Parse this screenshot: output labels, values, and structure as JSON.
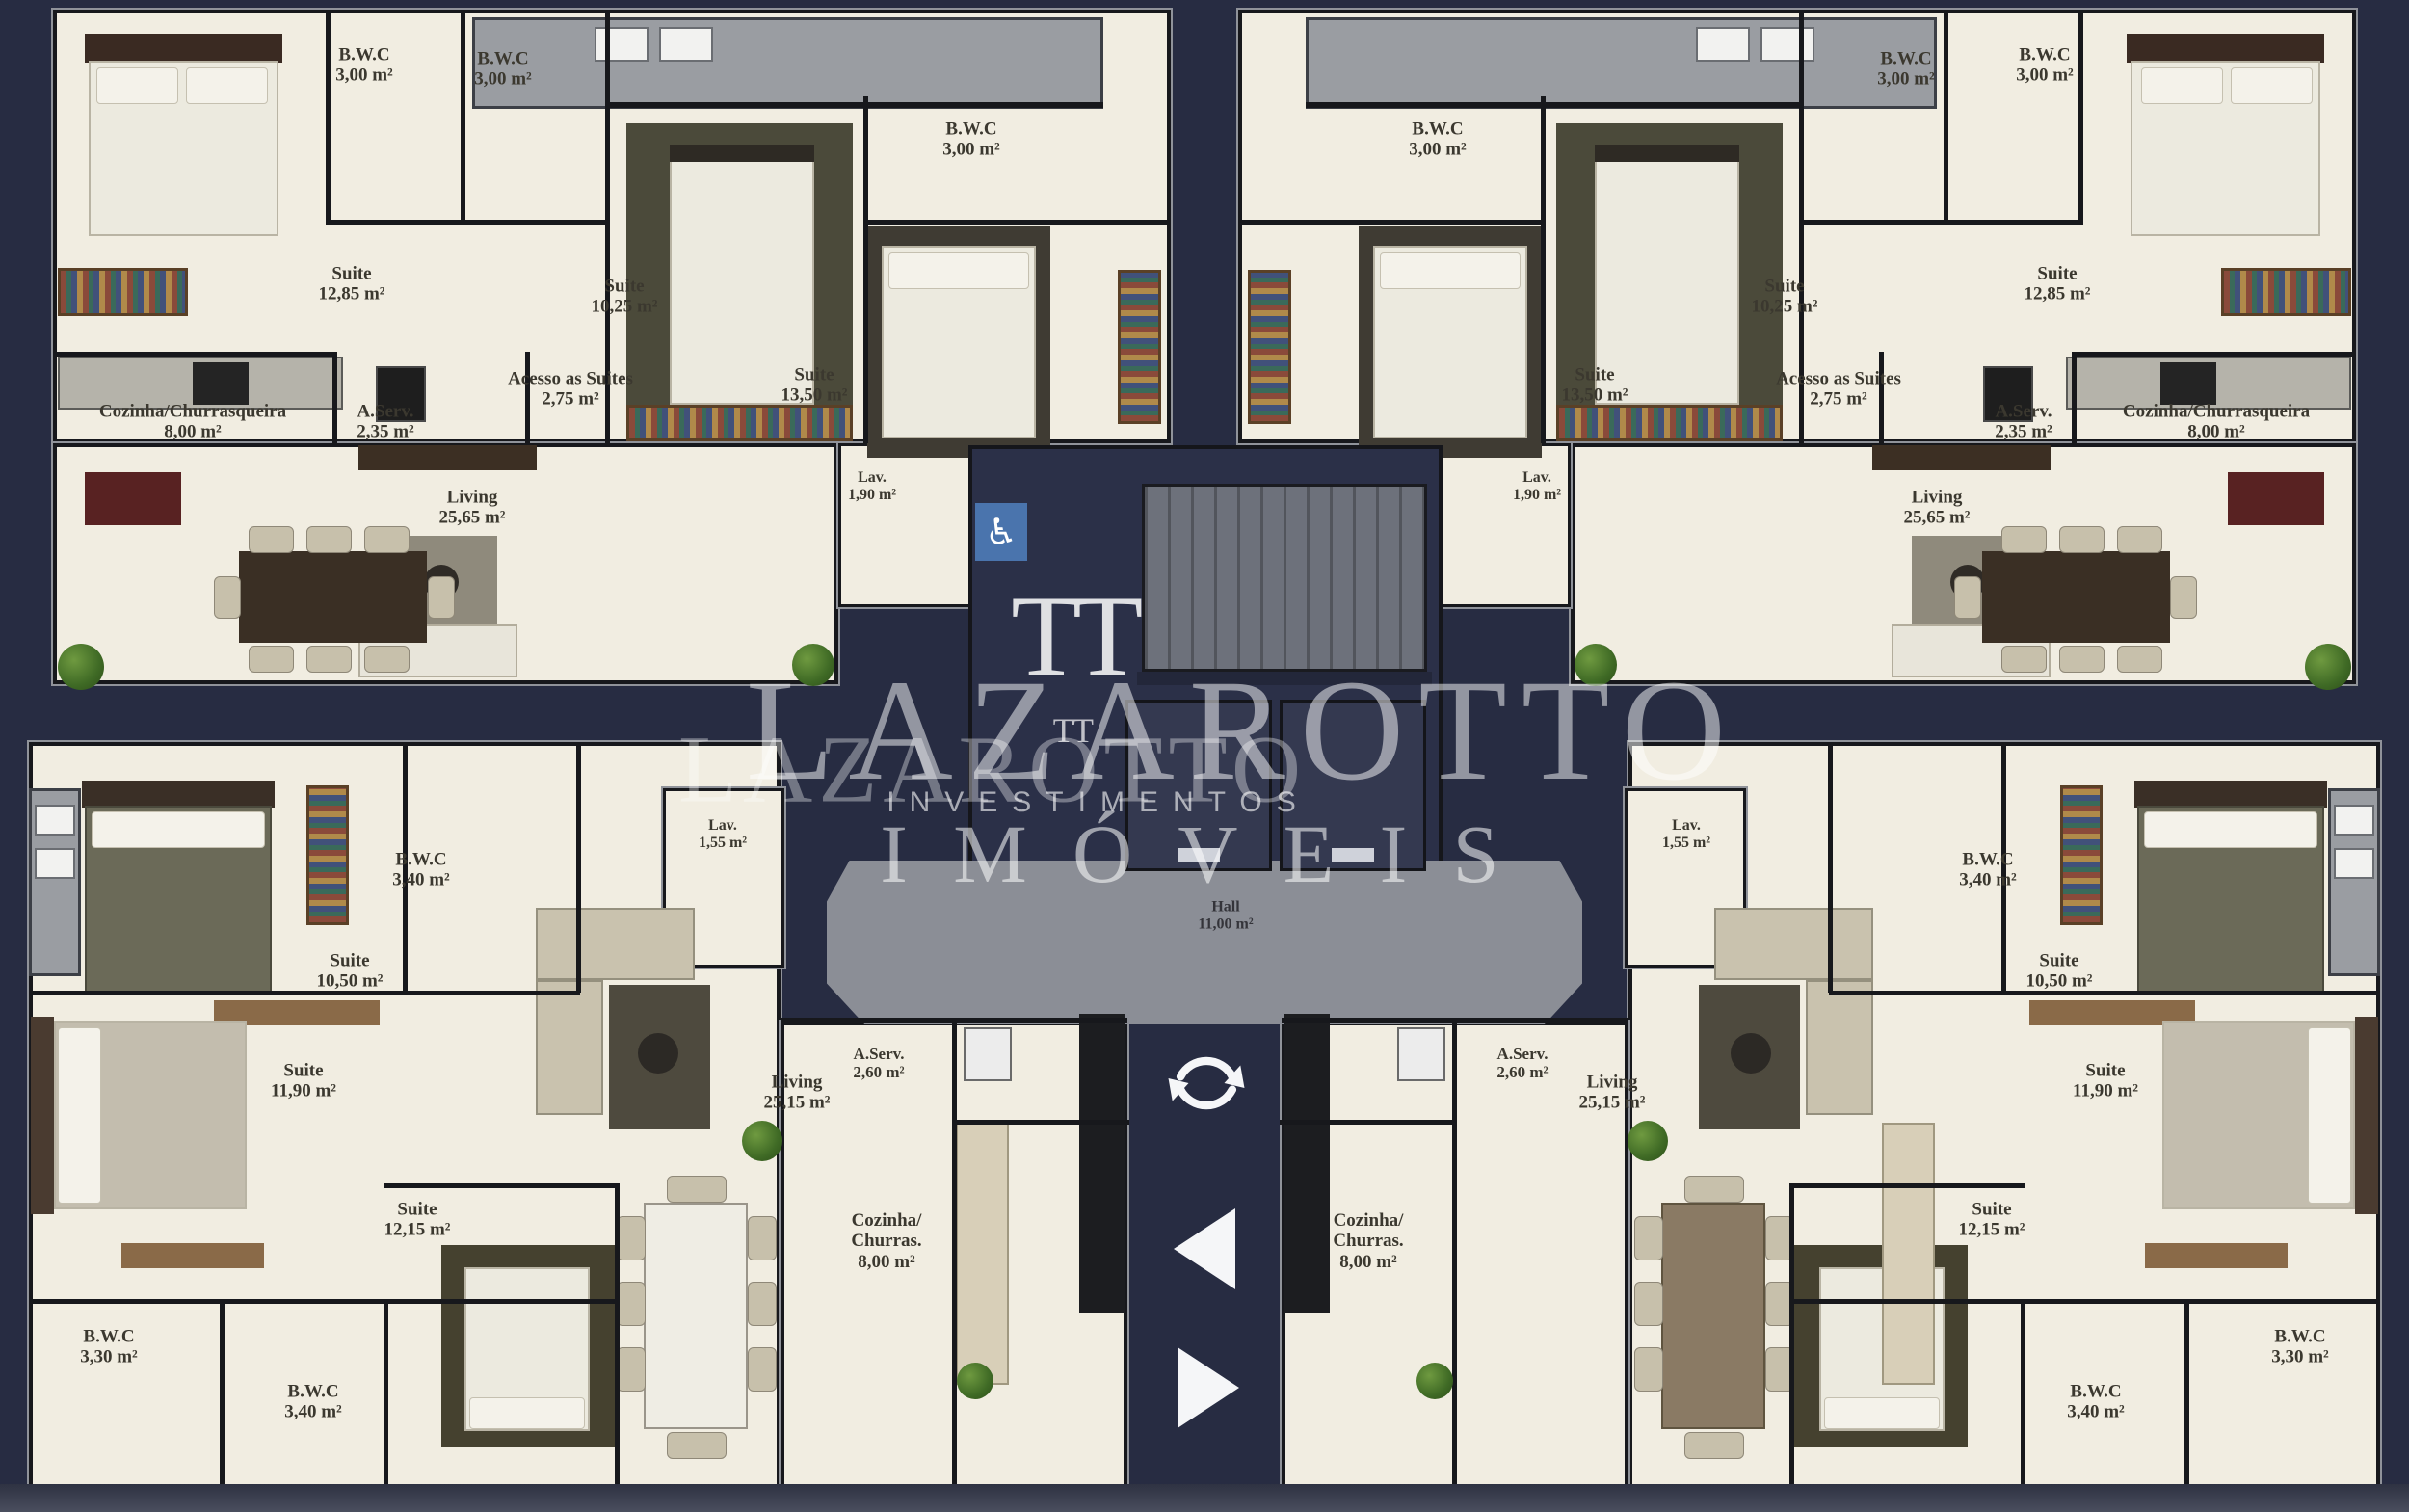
{
  "page": {
    "background": "#272c42",
    "floor_color": "#f1ede1",
    "wall_color": "#17181c",
    "hall_floor_color": "#8b8e96",
    "core_color": "#2b3048",
    "accent_blue": "#4a74ad",
    "watermark_color": "#ffffff"
  },
  "watermark": {
    "monogram": "TT",
    "brand": "LAZAROTTO",
    "subtitle": "INVESTIMENTOS",
    "tagline": "IMÓVEIS"
  },
  "hall": {
    "label": "Hall",
    "area": "11,00 m²"
  },
  "controls": {
    "rotate_icon": "rotate-arrows",
    "previous_icon": "triangle-left",
    "next_icon": "triangle-right"
  },
  "accessibility": {
    "wheelchair_icon": "wheelchair-accessible"
  },
  "units": {
    "tl": {
      "name": "apartment-top-left",
      "rooms": {
        "suite_a": {
          "label": "Suite",
          "area": "12,85 m²"
        },
        "bwc_a": {
          "label": "B.W.C",
          "area": "3,00 m²"
        },
        "bwc_b": {
          "label": "B.W.C",
          "area": "3,00 m²"
        },
        "suite_b": {
          "label": "Suite",
          "area": "10,25 m²"
        },
        "bwc_c": {
          "label": "B.W.C",
          "area": "3,00 m²"
        },
        "suite_c": {
          "label": "Suite",
          "area": "13,50 m²"
        },
        "acesso": {
          "label": "Acesso as Suites",
          "area": "2,75 m²"
        },
        "cozinha": {
          "label": "Cozinha/Churrasqueira",
          "area": "8,00 m²"
        },
        "aserv": {
          "label": "A.Serv.",
          "area": "2,35 m²"
        },
        "living": {
          "label": "Living",
          "area": "25,65 m²"
        },
        "lav": {
          "label": "Lav.",
          "area": "1,90 m²"
        }
      }
    },
    "tr": {
      "name": "apartment-top-right",
      "rooms": {
        "suite_a": {
          "label": "Suite",
          "area": "12,85 m²"
        },
        "bwc_a": {
          "label": "B.W.C",
          "area": "3,00 m²"
        },
        "bwc_b": {
          "label": "B.W.C",
          "area": "3,00 m²"
        },
        "suite_b": {
          "label": "Suite",
          "area": "10,25 m²"
        },
        "bwc_c": {
          "label": "B.W.C",
          "area": "3,00 m²"
        },
        "suite_c": {
          "label": "Suite",
          "area": "13,50 m²"
        },
        "acesso": {
          "label": "Acesso as Suites",
          "area": "2,75 m²"
        },
        "cozinha": {
          "label": "Cozinha/Churrasqueira",
          "area": "8,00 m²"
        },
        "aserv": {
          "label": "A.Serv.",
          "area": "2,35 m²"
        },
        "living": {
          "label": "Living",
          "area": "25,65 m²"
        },
        "lav": {
          "label": "Lav.",
          "area": "1,90 m²"
        }
      }
    },
    "bl": {
      "name": "apartment-bottom-left",
      "rooms": {
        "suite_a": {
          "label": "Suite",
          "area": "10,50 m²"
        },
        "bwc_a": {
          "label": "B.W.C",
          "area": "3,40 m²"
        },
        "lav": {
          "label": "Lav.",
          "area": "1,55 m²"
        },
        "suite_b": {
          "label": "Suite",
          "area": "11,90 m²"
        },
        "suite_c": {
          "label": "Suite",
          "area": "12,15 m²"
        },
        "bwc_b": {
          "label": "B.W.C",
          "area": "3,30 m²"
        },
        "bwc_c": {
          "label": "B.W.C",
          "area": "3,40 m²"
        },
        "living": {
          "label": "Living",
          "area": "25,15 m²"
        },
        "cozinha": {
          "label": "Cozinha/ Churras.",
          "area": "8,00 m²"
        },
        "aserv": {
          "label": "A.Serv.",
          "area": "2,60 m²"
        }
      }
    },
    "br": {
      "name": "apartment-bottom-right",
      "rooms": {
        "suite_a": {
          "label": "Suite",
          "area": "10,50 m²"
        },
        "bwc_a": {
          "label": "B.W.C",
          "area": "3,40 m²"
        },
        "lav": {
          "label": "Lav.",
          "area": "1,55 m²"
        },
        "suite_b": {
          "label": "Suite",
          "area": "11,90 m²"
        },
        "suite_c": {
          "label": "Suite",
          "area": "12,15 m²"
        },
        "bwc_b": {
          "label": "B.W.C",
          "area": "3,30 m²"
        },
        "bwc_c": {
          "label": "B.W.C",
          "area": "3,40 m²"
        },
        "living": {
          "label": "Living",
          "area": "25,15 m²"
        },
        "cozinha": {
          "label": "Cozinha/ Churras.",
          "area": "8,00 m²"
        },
        "aserv": {
          "label": "A.Serv.",
          "area": "2,60 m²"
        }
      }
    }
  }
}
